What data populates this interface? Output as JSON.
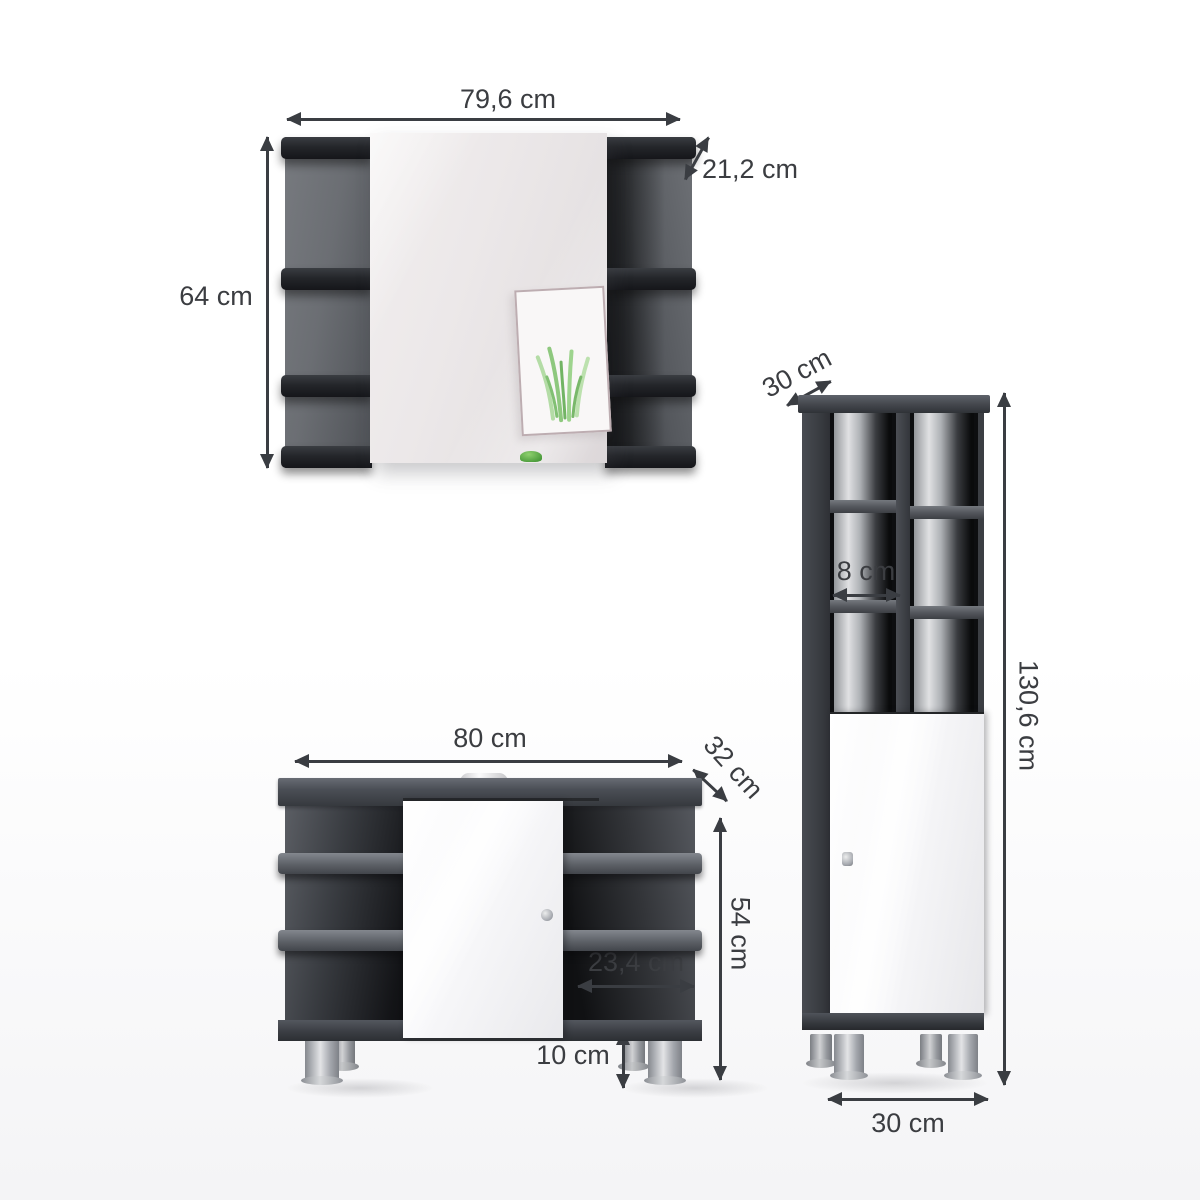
{
  "diagram": {
    "type": "bathroom furniture set dimension diagram",
    "units": "cm",
    "arrow_color": "#3a3d42",
    "text_color": "#3b3d41",
    "background": "#ffffff"
  },
  "mirror_cabinet": {
    "width": "79,6 cm",
    "depth": "21,2 cm",
    "height": "64 cm"
  },
  "tall_cabinet": {
    "depth": "30 cm",
    "cubby_width": "8 cm",
    "height": "130,6 cm",
    "door_height": "59,2 cm",
    "width": "30 cm"
  },
  "sink_cabinet": {
    "width": "80 cm",
    "depth": "32 cm",
    "height": "54 cm",
    "shelf_width": "23,4 cm",
    "foot_height": "10 cm"
  },
  "colors": {
    "cabinet_dark": "#3e4146",
    "cabinet_top_face": "#5e626a",
    "interior_dark": "#121316",
    "shelf_edge_gray": "#7a7e85",
    "door_white": "#f7f7f9",
    "mirror_tint": "#e9e5e6",
    "feet_silver": "#b8bbc0",
    "frame_border": "#bdadb1",
    "plant_green": "#6fbe58"
  }
}
